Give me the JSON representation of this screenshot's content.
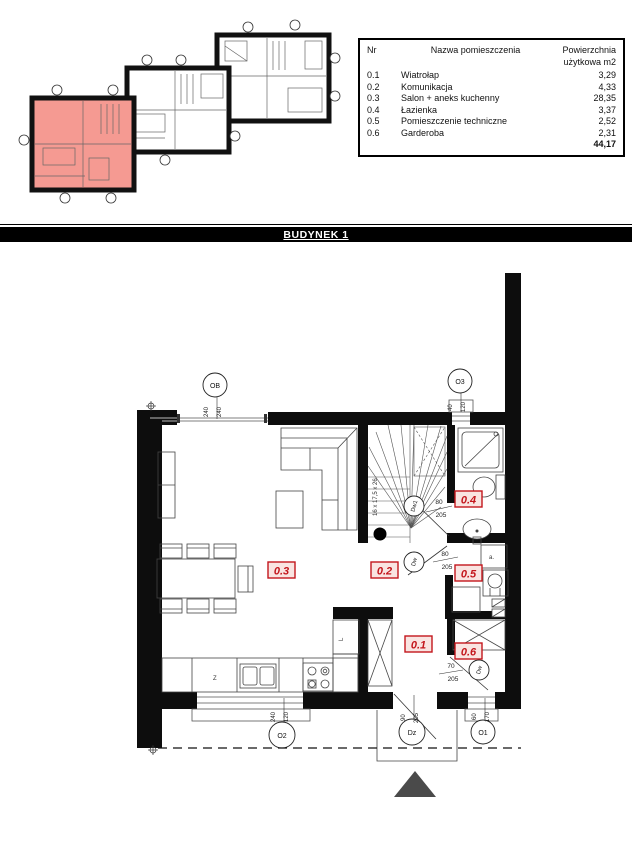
{
  "banner": {
    "title": "BUDYNEK 1"
  },
  "legend": {
    "headers": {
      "nr": "Nr",
      "name": "Nazwa pomieszczenia",
      "area_line1": "Powierzchnia",
      "area_line2": "użytkowa m2"
    },
    "rows": [
      {
        "nr": "0.1",
        "name": "Wiatrołap",
        "area": "3,29"
      },
      {
        "nr": "0.2",
        "name": "Komunikacja",
        "area": "4,33"
      },
      {
        "nr": "0.3",
        "name": "Salon + aneks kuchenny",
        "area": "28,35"
      },
      {
        "nr": "0.4",
        "name": "Łazienka",
        "area": "3,37"
      },
      {
        "nr": "0.5",
        "name": "Pomieszczenie techniczne",
        "area": "2,52"
      },
      {
        "nr": "0.6",
        "name": "Garderoba",
        "area": "2,31"
      }
    ],
    "total": "44,17"
  },
  "plan": {
    "rooms": {
      "r01": "0.1",
      "r02": "0.2",
      "r03": "0.3",
      "r04": "0.4",
      "r05": "0.5",
      "r06": "0.6"
    },
    "openings": {
      "ob": {
        "label": "OB",
        "w": "240",
        "h": "240"
      },
      "o3": {
        "label": "O3",
        "w": "40",
        "h": "120"
      },
      "o2": {
        "label": "O2",
        "w": "240",
        "h": "120"
      },
      "o1": {
        "label": "O1",
        "w": "60",
        "h": "170"
      },
      "dz": {
        "label": "Dz",
        "w": "90",
        "h": "205"
      },
      "dw1": {
        "label": "Dw1",
        "w": "80",
        "h": "205"
      },
      "dw5": {
        "label": "Dw",
        "w": "80",
        "h": "205"
      },
      "dw6": {
        "label": "Dw",
        "w": "70",
        "h": "205"
      }
    },
    "notes": {
      "stairs": "16 x 17,5 x 26",
      "sink": "Z",
      "fridge": "L",
      "boiler": "a."
    }
  },
  "colors": {
    "highlight_unit": "#f59a92",
    "label_red": "#c3161c",
    "banner_bg": "#000000"
  }
}
